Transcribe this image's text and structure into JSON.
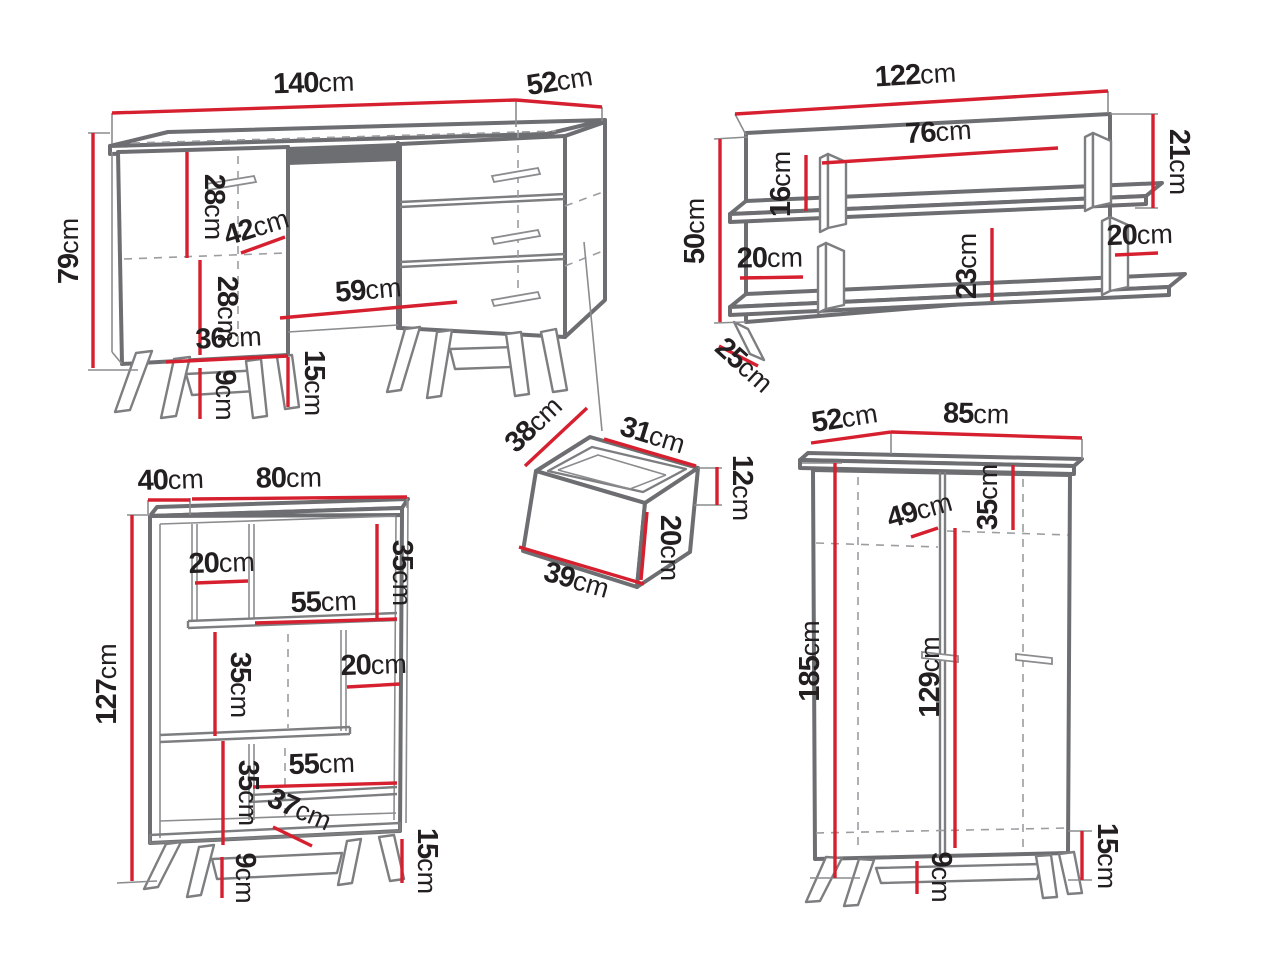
{
  "title": "furniture set dimension diagram",
  "unit": "cm",
  "colors": {
    "background": "#ffffff",
    "outline_gray": "#6d6e71",
    "thin_gray": "#8a8c8e",
    "dashed_gray": "#9b9da0",
    "dimension_red": "#d6202f",
    "label_black": "#231f20"
  },
  "pieces": {
    "desk": {
      "name": "dressing-table-desk",
      "dims": {
        "width": {
          "v": "140",
          "u": "cm"
        },
        "depth": {
          "v": "52",
          "u": "cm"
        },
        "height": {
          "v": "79",
          "u": "cm"
        },
        "upper_door": {
          "v": "28",
          "u": "cm"
        },
        "door_width": {
          "v": "42",
          "u": "cm"
        },
        "lower_door": {
          "v": "28",
          "u": "cm"
        },
        "knee_space": {
          "v": "59",
          "u": "cm"
        },
        "cabinet_width": {
          "v": "36",
          "u": "cm"
        },
        "base_height": {
          "v": "15",
          "u": "cm"
        },
        "leg_height": {
          "v": "9",
          "u": "cm"
        }
      }
    },
    "wall_shelf": {
      "name": "wall-shelf",
      "dims": {
        "width": {
          "v": "122",
          "u": "cm"
        },
        "height": {
          "v": "50",
          "u": "cm"
        },
        "depth": {
          "v": "25",
          "u": "cm"
        },
        "inner_span": {
          "v": "76",
          "u": "cm"
        },
        "divider_height": {
          "v": "16",
          "u": "cm"
        },
        "right_drop": {
          "v": "21",
          "u": "cm"
        },
        "left_gap": {
          "v": "20",
          "u": "cm"
        },
        "middle_height": {
          "v": "23",
          "u": "cm"
        },
        "right_gap": {
          "v": "20",
          "u": "cm"
        }
      }
    },
    "drawer": {
      "name": "drawer-box",
      "dims": {
        "side_depth": {
          "v": "38",
          "u": "cm"
        },
        "inner_width": {
          "v": "31",
          "u": "cm"
        },
        "back_height": {
          "v": "12",
          "u": "cm"
        },
        "front_height": {
          "v": "20",
          "u": "cm"
        },
        "front_width": {
          "v": "39",
          "u": "cm"
        }
      }
    },
    "bookcase": {
      "name": "bookcase",
      "dims": {
        "depth": {
          "v": "40",
          "u": "cm"
        },
        "width": {
          "v": "80",
          "u": "cm"
        },
        "height": {
          "v": "127",
          "u": "cm"
        },
        "top_gap": {
          "v": "20",
          "u": "cm"
        },
        "top_height": {
          "v": "35",
          "u": "cm"
        },
        "top_span": {
          "v": "55",
          "u": "cm"
        },
        "mid_height": {
          "v": "35",
          "u": "cm"
        },
        "mid_gap": {
          "v": "20",
          "u": "cm"
        },
        "low_height": {
          "v": "35",
          "u": "cm"
        },
        "low_span": {
          "v": "55",
          "u": "cm"
        },
        "base_depth": {
          "v": "37",
          "u": "cm"
        },
        "leg_height": {
          "v": "9",
          "u": "cm"
        },
        "base_height": {
          "v": "15",
          "u": "cm"
        }
      }
    },
    "wardrobe": {
      "name": "wardrobe",
      "dims": {
        "depth": {
          "v": "52",
          "u": "cm"
        },
        "width": {
          "v": "85",
          "u": "cm"
        },
        "height": {
          "v": "185",
          "u": "cm"
        },
        "inner_depth": {
          "v": "49",
          "u": "cm"
        },
        "top_shelf": {
          "v": "35",
          "u": "cm"
        },
        "door_height": {
          "v": "129",
          "u": "cm"
        },
        "leg_height": {
          "v": "9",
          "u": "cm"
        },
        "base_height": {
          "v": "15",
          "u": "cm"
        }
      }
    }
  }
}
